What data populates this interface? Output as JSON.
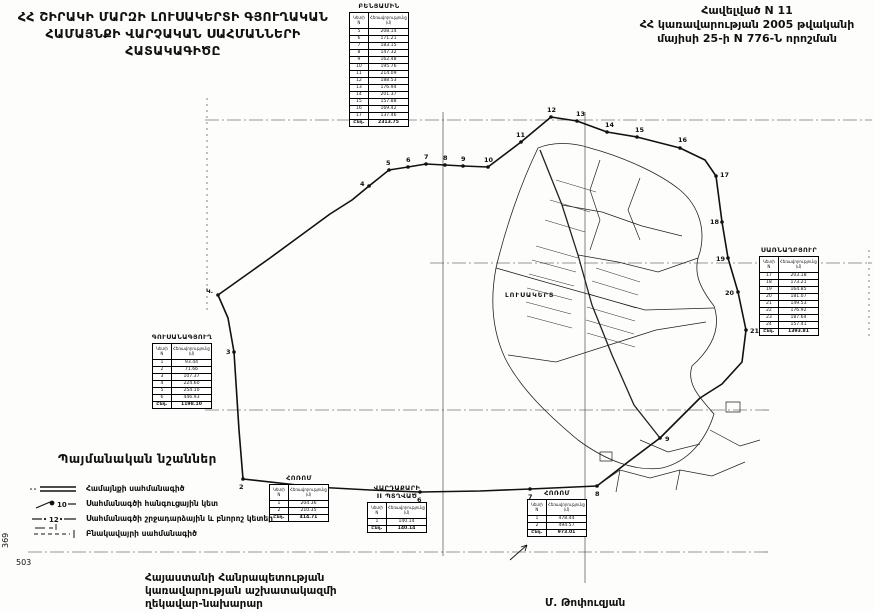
{
  "header": {
    "title_lines": [
      "ՀՀ ՇԻՐԱԿԻ ՄԱՐԶԻ ԼՈՒՍԱԿԵՐՏԻ ԳՅՈՒՂԱԿԱՆ",
      "ՀԱՄԱՅՆՔԻ ՎԱՐՉԱԿԱՆ ՍԱՀՄԱՆՆԵՐԻ",
      "ՀԱՏԱԿԱԳԻԾԸ"
    ],
    "decree_lines": [
      "Հավելված N 11",
      "ՀՀ կառավարության 2005 թվականի",
      "մայիսի 25-ի N 776-Ն որոշման"
    ]
  },
  "map": {
    "settlement_label": "ԼՈՒՍԱԿԵՐՏ",
    "sheet_number_vertical": "369",
    "sheet_number": "503",
    "points": [
      {
        "n": "Կ.",
        "x": 218,
        "y": 295,
        "dx": -12,
        "dy": -2
      },
      {
        "n": "2",
        "x": 243,
        "y": 479,
        "dx": -4,
        "dy": 10
      },
      {
        "n": "3",
        "x": 234,
        "y": 352,
        "dx": -8,
        "dy": 2
      },
      {
        "n": "4",
        "x": 369,
        "y": 186,
        "dx": -9,
        "dy": 0
      },
      {
        "n": "5",
        "x": 389,
        "y": 170,
        "dx": -3,
        "dy": -5
      },
      {
        "n": "6",
        "x": 408,
        "y": 167,
        "dx": -2,
        "dy": -5
      },
      {
        "n": "7",
        "x": 426,
        "y": 164,
        "dx": -2,
        "dy": -5
      },
      {
        "n": "8",
        "x": 445,
        "y": 165,
        "dx": -2,
        "dy": -5
      },
      {
        "n": "9",
        "x": 463,
        "y": 166,
        "dx": -2,
        "dy": -5
      },
      {
        "n": "10",
        "x": 488,
        "y": 167,
        "dx": -4,
        "dy": -5
      },
      {
        "n": "11",
        "x": 521,
        "y": 142,
        "dx": -5,
        "dy": -5
      },
      {
        "n": "12",
        "x": 551,
        "y": 117,
        "dx": -4,
        "dy": -5
      },
      {
        "n": "13",
        "x": 577,
        "y": 121,
        "dx": -1,
        "dy": -5
      },
      {
        "n": "14",
        "x": 607,
        "y": 132,
        "dx": -2,
        "dy": -5
      },
      {
        "n": "15",
        "x": 637,
        "y": 137,
        "dx": -2,
        "dy": -5
      },
      {
        "n": "16",
        "x": 680,
        "y": 148,
        "dx": -2,
        "dy": -6
      },
      {
        "n": "17",
        "x": 716,
        "y": 176,
        "dx": 4,
        "dy": 1
      },
      {
        "n": "18",
        "x": 722,
        "y": 222,
        "dx": -12,
        "dy": 2
      },
      {
        "n": "19",
        "x": 728,
        "y": 258,
        "dx": -12,
        "dy": 3
      },
      {
        "n": "20",
        "x": 738,
        "y": 292,
        "dx": -13,
        "dy": 3
      },
      {
        "n": "21",
        "x": 746,
        "y": 330,
        "dx": 4,
        "dy": 3
      },
      {
        "n": "9",
        "x": 660,
        "y": 438,
        "dx": 5,
        "dy": 3
      },
      {
        "n": "8",
        "x": 597,
        "y": 486,
        "dx": -2,
        "dy": 10
      },
      {
        "n": "7",
        "x": 530,
        "y": 489,
        "dx": -2,
        "dy": 10
      },
      {
        "n": "6",
        "x": 420,
        "y": 492,
        "dx": -3,
        "dy": 10
      },
      {
        "n": "5",
        "x": 315,
        "y": 487,
        "dx": -3,
        "dy": 10
      }
    ]
  },
  "tables": {
    "cols": {
      "n": "Կետի N",
      "d": "Հեռավորությունը (մ)"
    },
    "benyamin": {
      "title": "ԲԵՆՅԱՄԻՆ",
      "rows": [
        [
          "5",
          "208.14"
        ],
        [
          "6",
          "171.21"
        ],
        [
          "7",
          "183.15"
        ],
        [
          "8",
          "147.32"
        ],
        [
          "9",
          "162.48"
        ],
        [
          "10",
          "195.76"
        ],
        [
          "11",
          "214.09"
        ],
        [
          "12",
          "188.53"
        ],
        [
          "13",
          "176.94"
        ],
        [
          "14",
          "201.37"
        ],
        [
          "15",
          "157.88"
        ],
        [
          "16",
          "169.42"
        ],
        [
          "17",
          "137.46"
        ],
        [
          "Ընդ.",
          "2313.75"
        ]
      ]
    },
    "sarnaghbyur": {
      "title": "ՍԱՌՆԱՂԲՅՈՒՐ",
      "rows": [
        [
          "17",
          "203.18"
        ],
        [
          "18",
          "173.21"
        ],
        [
          "19",
          "164.85"
        ],
        [
          "20",
          "181.07"
        ],
        [
          "21",
          "149.53"
        ],
        [
          "22",
          "176.92"
        ],
        [
          "23",
          "187.64"
        ],
        [
          "24",
          "157.41"
        ],
        [
          "Ընդ.",
          "1393.81"
        ]
      ]
    },
    "gusanagyugh": {
      "title": "ԳՈՒՍԱՆԱԳՅՈՒՂ",
      "rows": [
        [
          "1",
          "93.44"
        ],
        [
          "2",
          "71.66"
        ],
        [
          "3",
          "107.37"
        ],
        [
          "4",
          "224.60"
        ],
        [
          "5",
          "254.10"
        ],
        [
          "6",
          "446.93"
        ],
        [
          "Ընդ.",
          "1198.10"
        ]
      ]
    },
    "horom1": {
      "title": "ՀՈՌՈՄ",
      "rows": [
        [
          "1",
          "204.36"
        ],
        [
          "2",
          "210.35"
        ],
        [
          "Ընդ.",
          "414.71"
        ]
      ]
    },
    "vardakar": {
      "title_line1": "ՎԱՐԴԱՔԱՐԻ",
      "title_line2": "II ՊՏՂՎԱԾ",
      "rows": [
        [
          "1",
          "140.14"
        ],
        [
          "Ընդ.",
          "140.14"
        ]
      ]
    },
    "horom2": {
      "title": "ՀՈՌՈՄ",
      "rows": [
        [
          "1",
          "478.44"
        ],
        [
          "2",
          "494.57"
        ],
        [
          "Ընդ.",
          "973.01"
        ]
      ]
    }
  },
  "legend": {
    "title": "Պայմանական նշաններ",
    "items": [
      {
        "icon": "community-boundary-symbol",
        "label": "Համայնքի սահմանագիծ"
      },
      {
        "icon": "node-point-symbol",
        "symbol_number": "10",
        "label": "Սահմանագծի հանգուցային կետ"
      },
      {
        "icon": "turning-point-symbol",
        "symbol_number": "12",
        "label": "Սահմանագծի շրջադարձային և բնորոշ կետեր"
      },
      {
        "icon": "settlement-boundary-symbol",
        "label": "Բնակավայրի սահմանագիծ"
      }
    ]
  },
  "footer": {
    "issuer_lines": [
      "Հայաստանի Հանրապետության",
      "կառավարության աշխատակազմի",
      "ղեկավար-նախարար"
    ],
    "signature": "Մ. Թոփուզյան"
  },
  "colors": {
    "ink": "#111111",
    "paper": "#fdfdfb"
  }
}
